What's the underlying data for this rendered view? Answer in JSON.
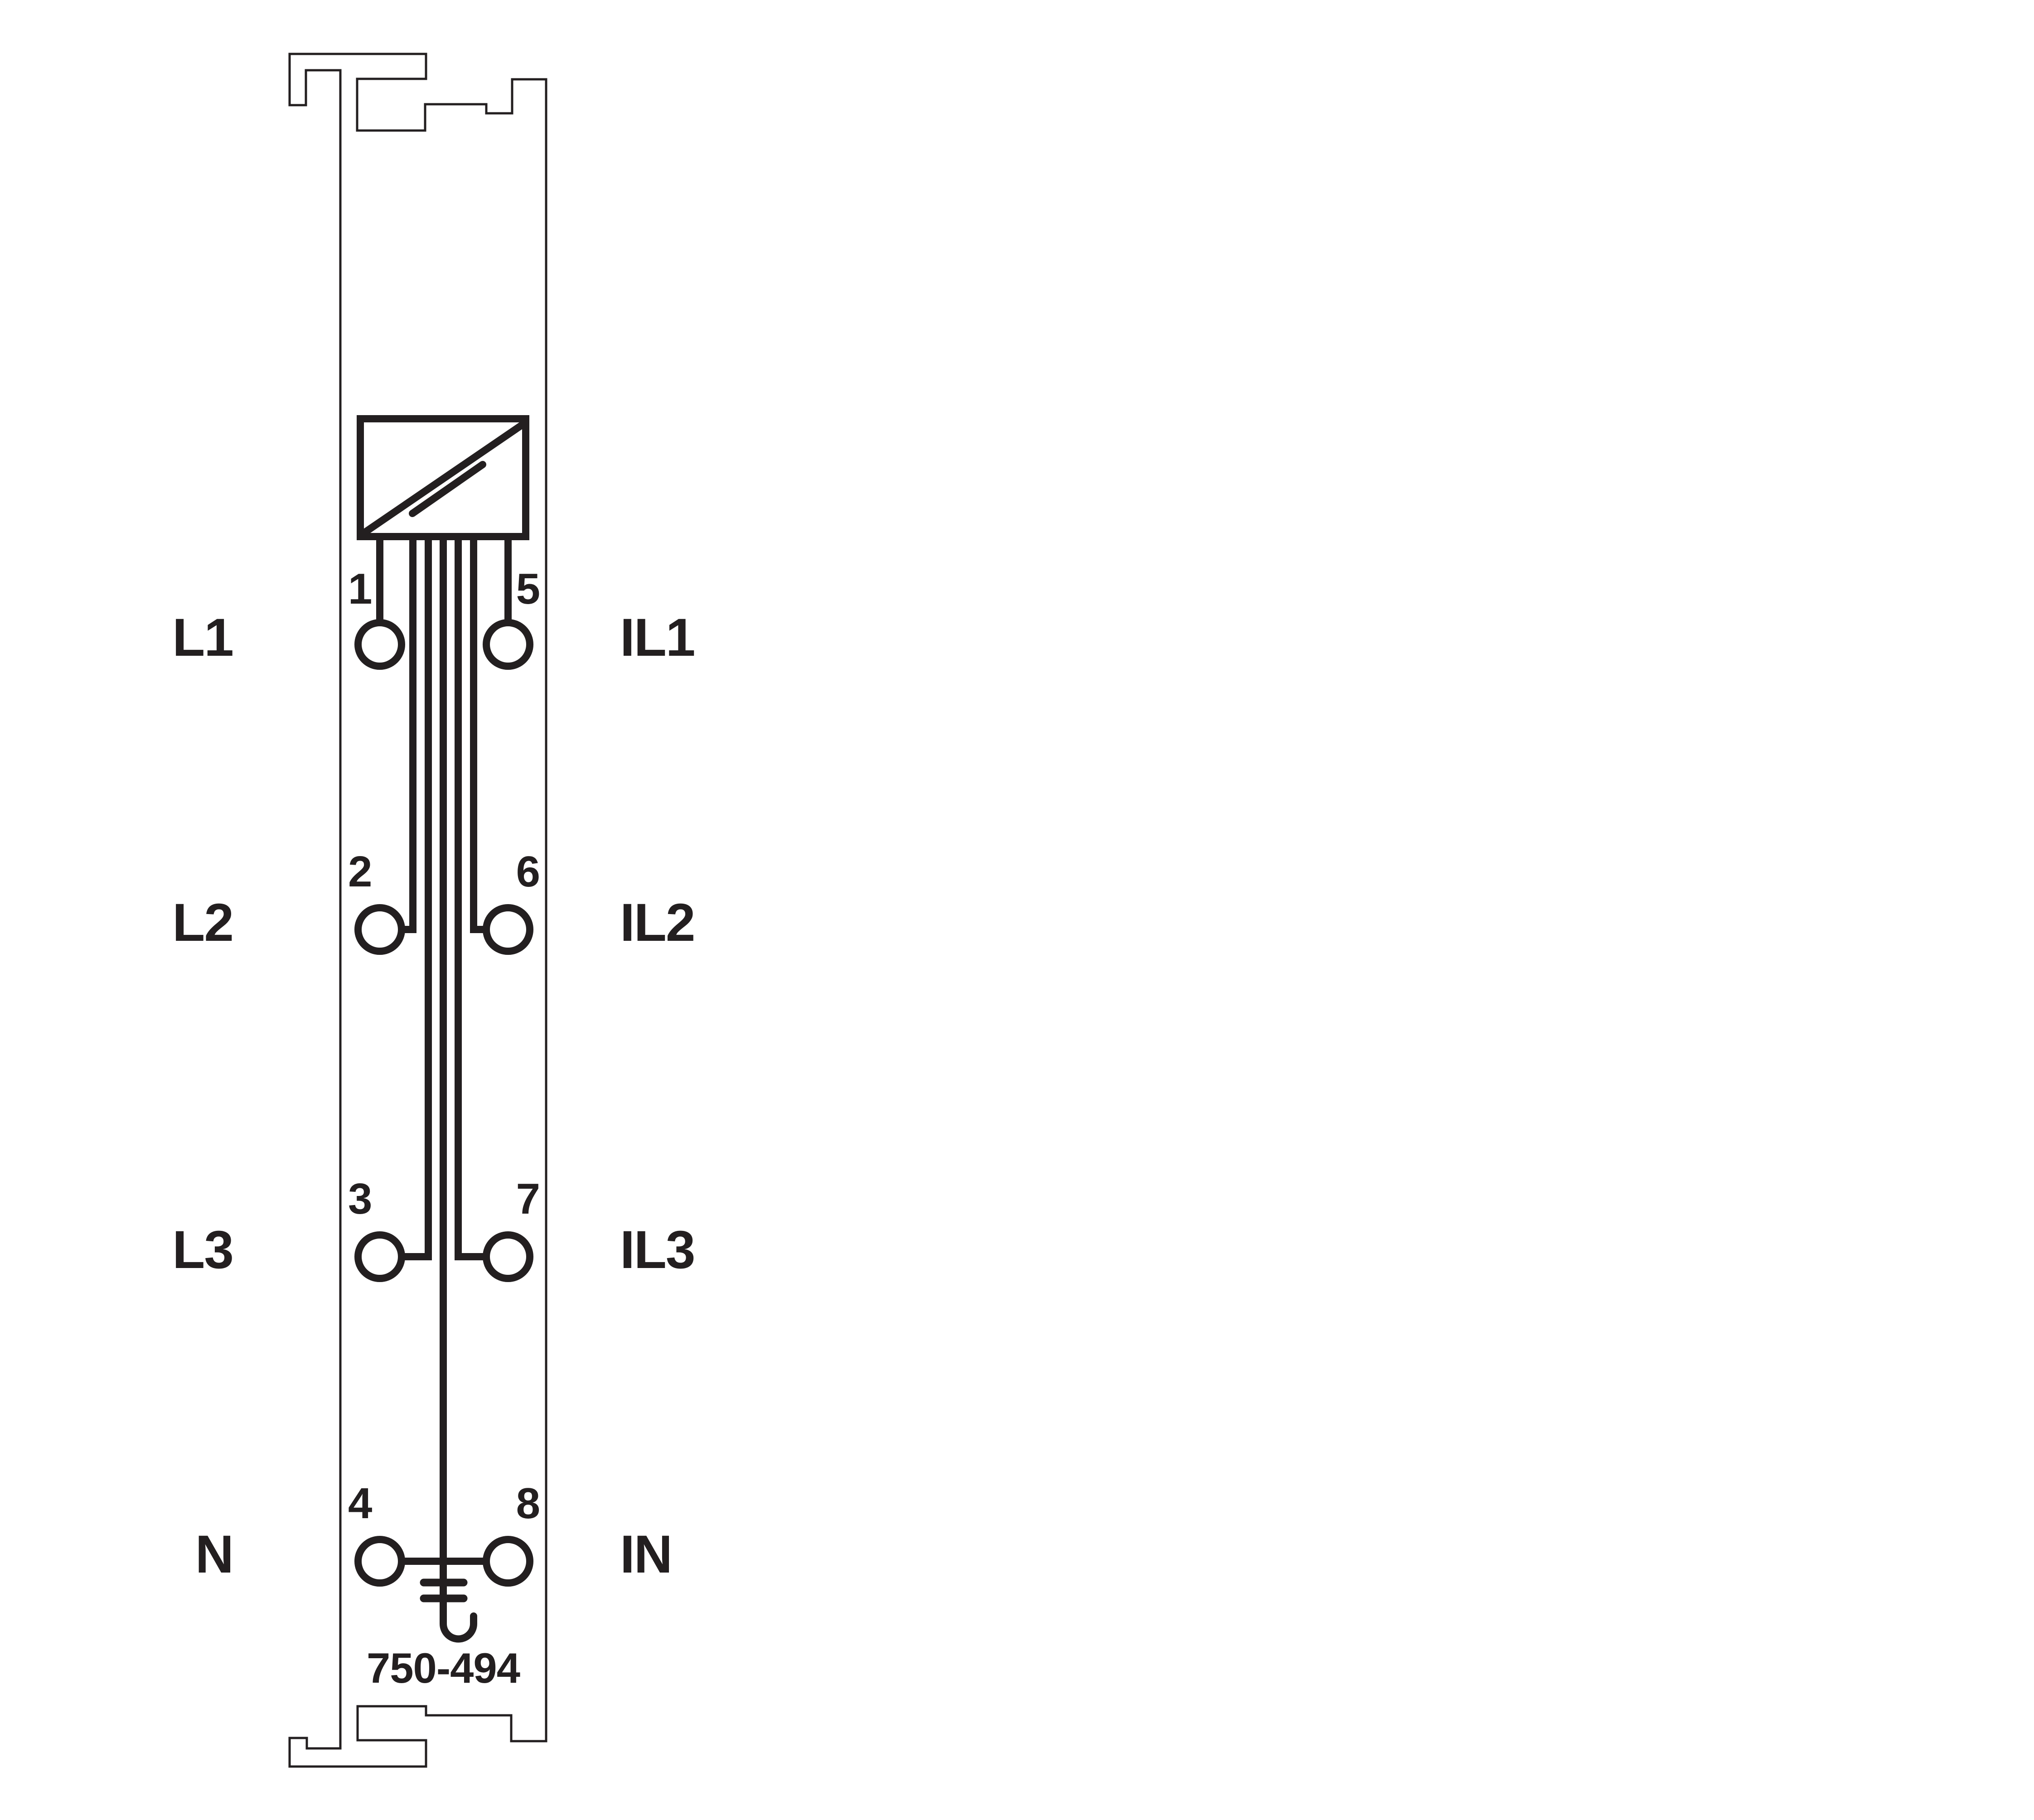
{
  "colors": {
    "line": "#231f20",
    "background": "#ffffff"
  },
  "module": {
    "part_number": "750-494",
    "symbols": {
      "transducer_icon": "box-with-diagonal-slash",
      "ground_icon": "functional-earth-hook"
    }
  },
  "terminals": [
    {
      "number": "1",
      "label": "L1",
      "side": "left"
    },
    {
      "number": "2",
      "label": "L2",
      "side": "left"
    },
    {
      "number": "3",
      "label": "L3",
      "side": "left"
    },
    {
      "number": "4",
      "label": "N",
      "side": "left"
    },
    {
      "number": "5",
      "label": "IL1",
      "side": "right"
    },
    {
      "number": "6",
      "label": "IL2",
      "side": "right"
    },
    {
      "number": "7",
      "label": "IL3",
      "side": "right"
    }
  ],
  "terminal8": {
    "number": "8",
    "label": "IN",
    "side": "right"
  }
}
